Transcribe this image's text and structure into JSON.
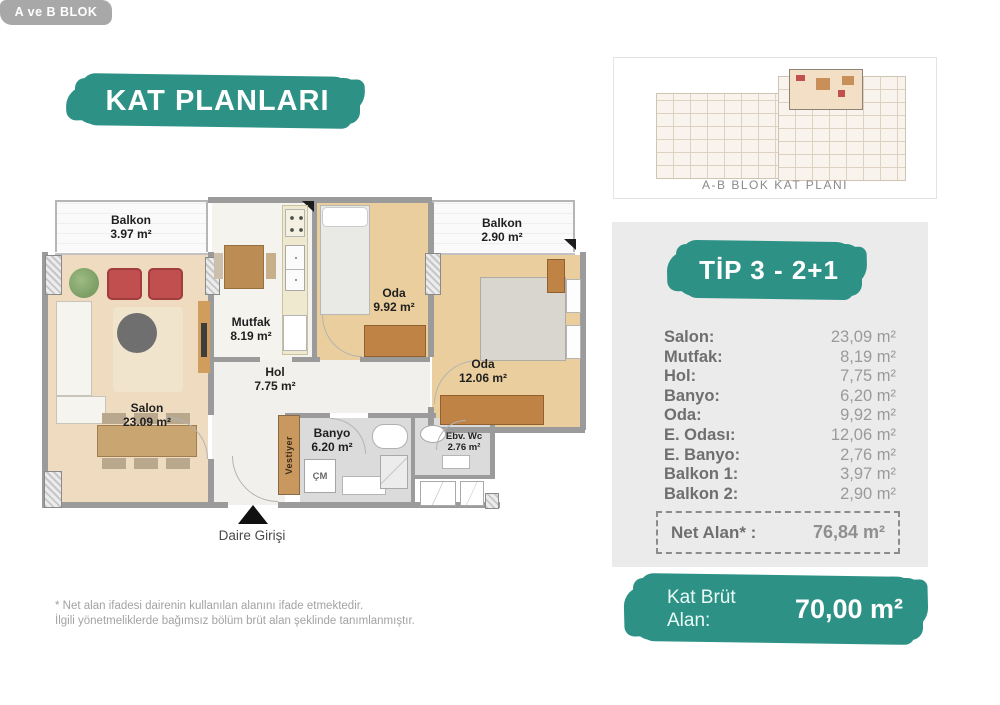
{
  "colors": {
    "teal": "#2D9285",
    "badge_gray": "#A8A8A8",
    "panel_gray": "#EBEBEB",
    "wall_gray": "#9B9B9B",
    "salon_floor": "#EFDCC0",
    "bedroom_floor": "#EACE9E",
    "wardrobe_wood": "#C08346",
    "armchair_red": "#C14F4F"
  },
  "header": {
    "title": "KAT PLANLARI",
    "block_badge": "A ve B BLOK"
  },
  "overview_card": {
    "caption": "A-B BLOK KAT PLANI"
  },
  "unit_panel": {
    "type_label": "TİP 3 - 2+1",
    "rooms": [
      {
        "label": "Salon:",
        "value": "23,09 m²"
      },
      {
        "label": "Mutfak:",
        "value": "8,19 m²"
      },
      {
        "label": "Hol:",
        "value": "7,75 m²"
      },
      {
        "label": "Banyo:",
        "value": "6,20 m²"
      },
      {
        "label": "Oda:",
        "value": "9,92 m²"
      },
      {
        "label": "E. Odası:",
        "value": "12,06 m²"
      },
      {
        "label": "E. Banyo:",
        "value": "2,76 m²"
      },
      {
        "label": "Balkon 1:",
        "value": "3,97 m²"
      },
      {
        "label": "Balkon 2:",
        "value": "2,90 m²"
      }
    ],
    "net_area": {
      "label": "Net Alan* :",
      "value": "76,84 m²"
    },
    "gross_area": {
      "label": "Kat Brüt Alan:",
      "value": "70,00 m²"
    }
  },
  "floor_plan": {
    "rooms": {
      "balkon1": {
        "name": "Balkon",
        "area": "3.97 m²"
      },
      "salon": {
        "name": "Salon",
        "area": "23.09 m²"
      },
      "mutfak": {
        "name": "Mutfak",
        "area": "8.19 m²"
      },
      "hol": {
        "name": "Hol",
        "area": "7.75 m²"
      },
      "oda1": {
        "name": "Oda",
        "area": "9.92 m²"
      },
      "balkon2": {
        "name": "Balkon",
        "area": "2.90 m²"
      },
      "oda2": {
        "name": "Oda",
        "area": "12.06 m²"
      },
      "banyo": {
        "name": "Banyo",
        "area": "6.20 m²"
      },
      "wc": {
        "name": "Ebv. Wc",
        "area": "2.76 m²"
      },
      "vestiyer": {
        "name": "Vestiyer"
      },
      "washing_machine": {
        "name": "ÇM"
      }
    },
    "entrance_label": "Daire Girişi"
  },
  "footnote": {
    "line1": "* Net alan ifadesi dairenin kullanılan alanını ifade etmektedir.",
    "line2": "İlgili yönetmeliklerde bağımsız bölüm brüt alan şeklinde tanımlanmıştır."
  }
}
